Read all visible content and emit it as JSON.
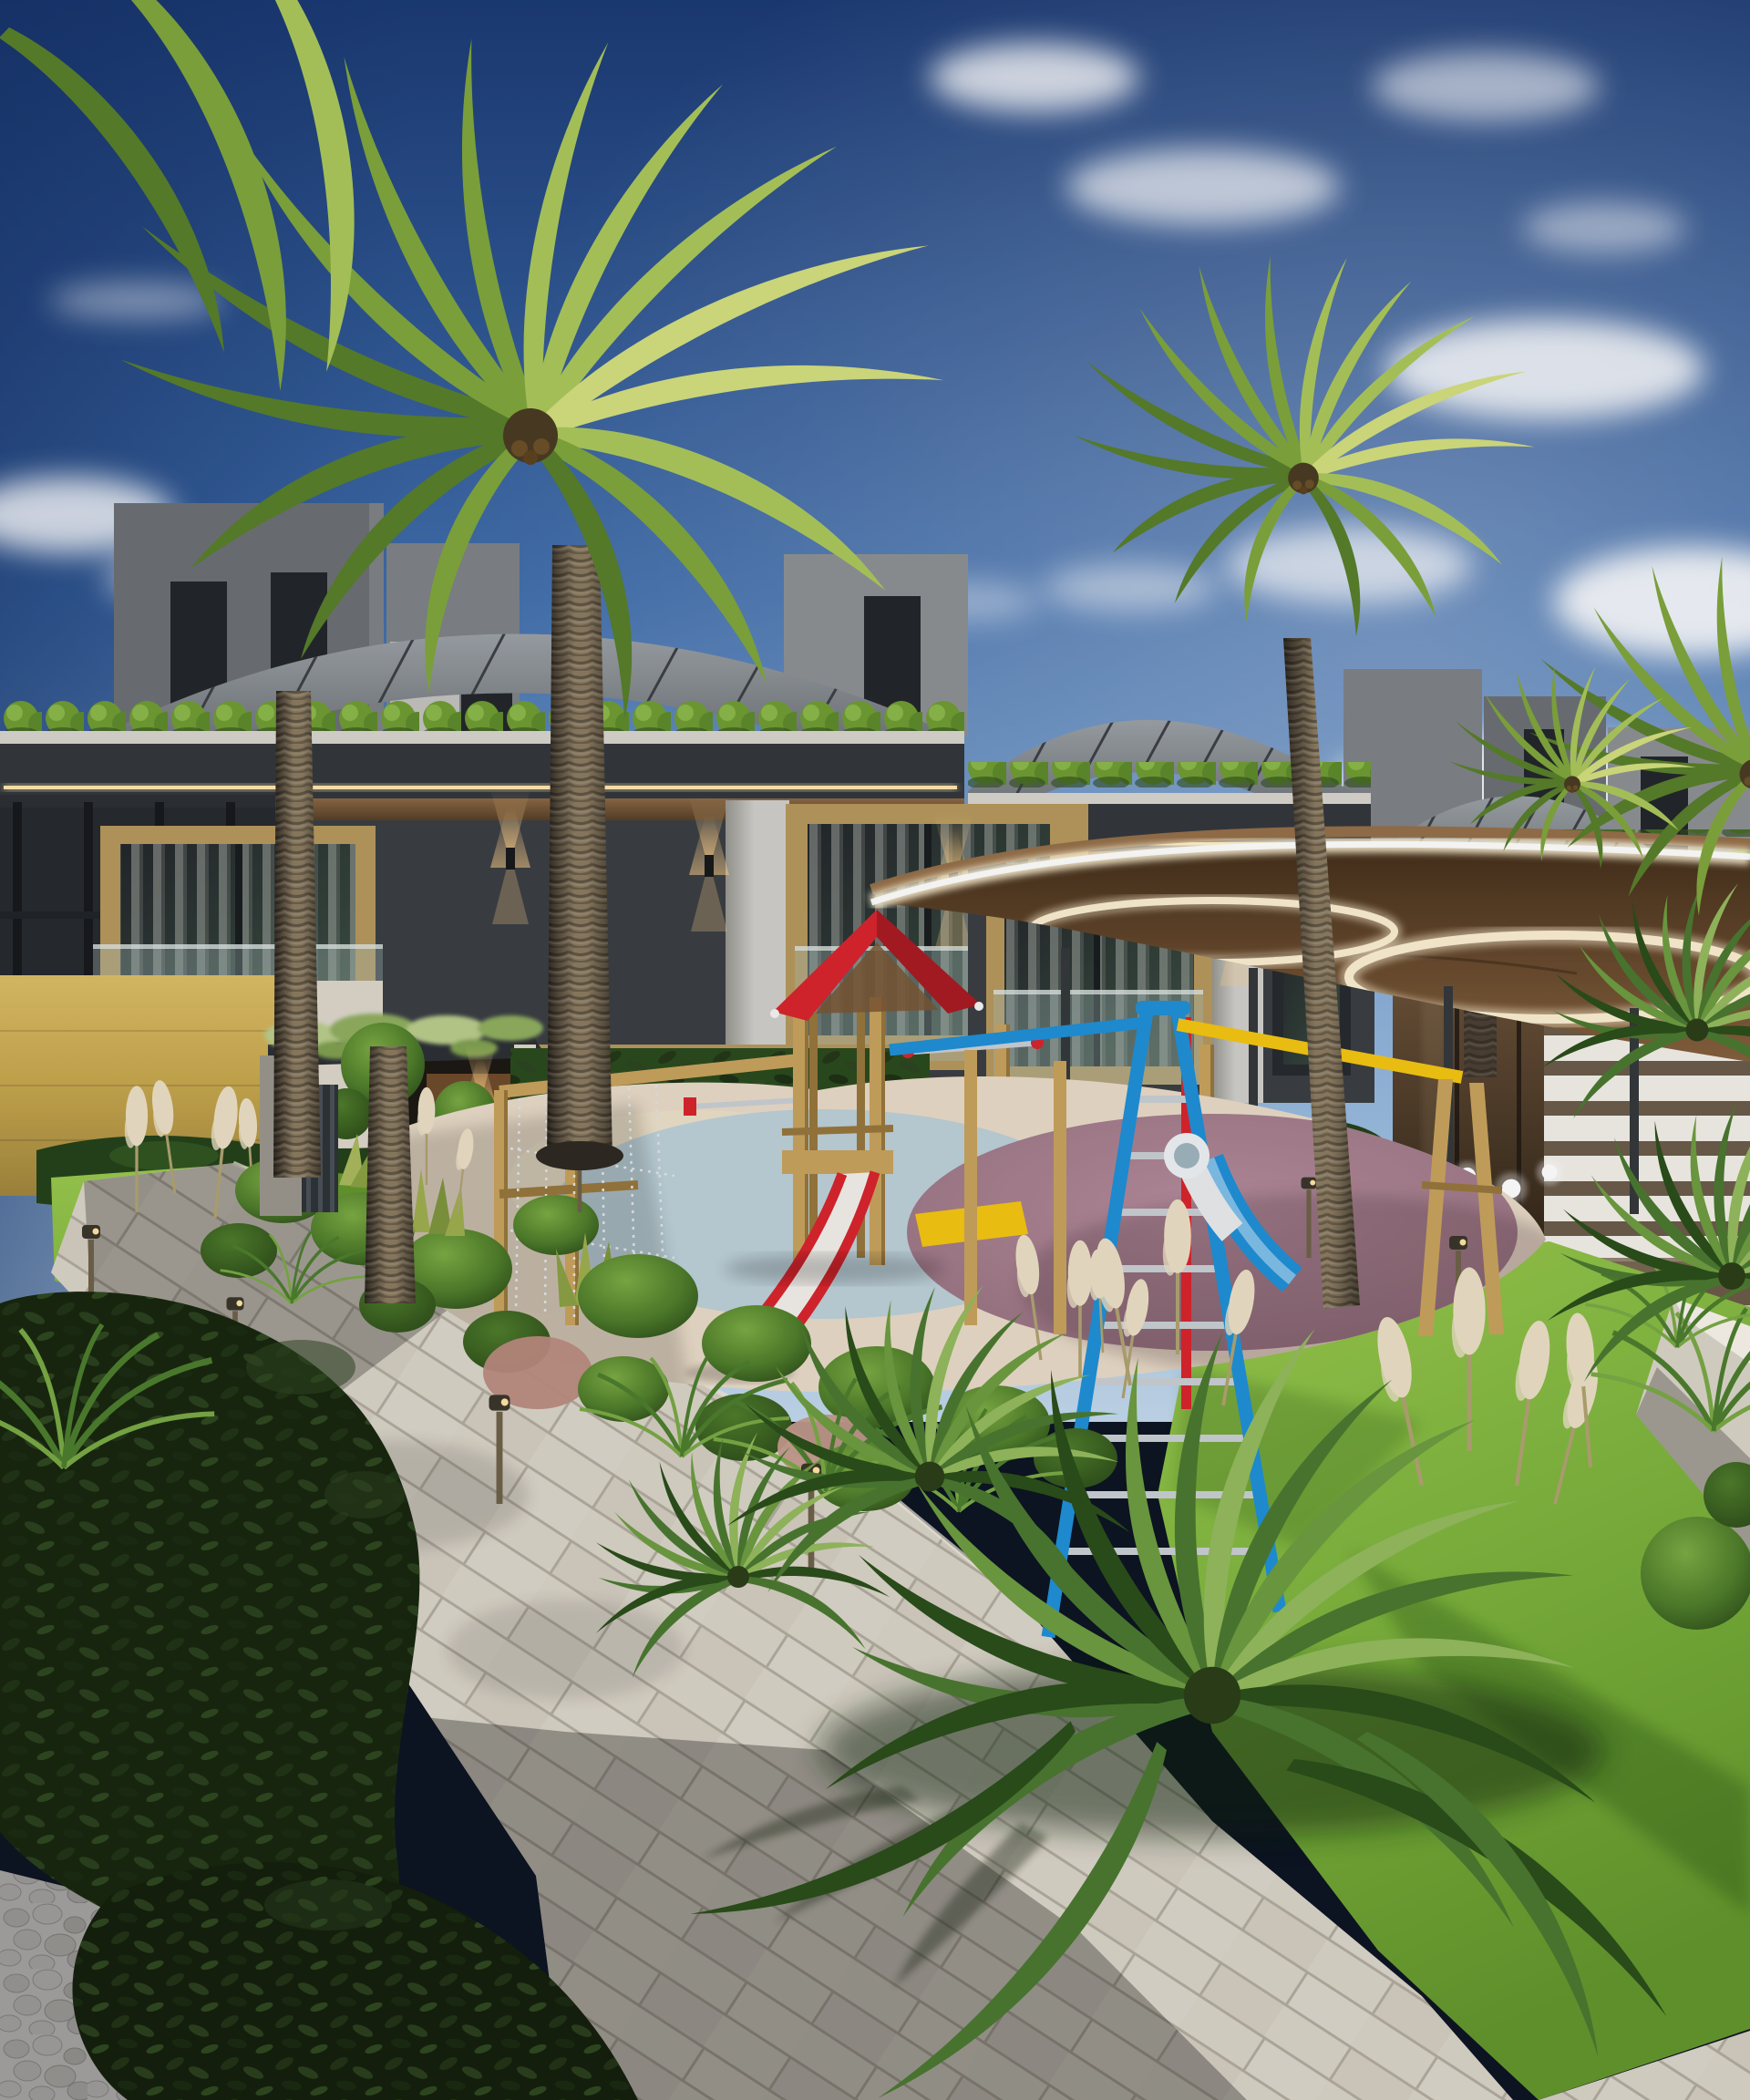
{
  "meta": {
    "title": "Residential complex exterior 3D rendering",
    "description": "Architectural visualization of a modern townhouse row with curved standing-seam roofs, rooftop planters, wood-panel facades, a large glowing circular canopy, a colorful wooden children's playground, palm trees, lush landscaped garden beds, pampas grass, a tiled walkway and garden lights under a blue sky with clouds."
  },
  "palette": {
    "sky-top": "#1b3a74",
    "sky-mid": "#3f6dab",
    "sky-low": "#82abd6",
    "sky-horizon": "#c3d9ec",
    "sky-deep": "#122c60",
    "cloud": "#ffffff",
    "roof-hi": "#9ba1a5",
    "roof-lo": "#595e63",
    "roof-seam": "#3c4045",
    "tower-a": "#6c7074",
    "tower-b": "#8d9093",
    "tower-c": "#c3c2be",
    "tower-d": "#7e8286",
    "win-dark": "#22262a",
    "glass-refl": "#3d5244",
    "planter": "#d7d4cb",
    "fascia": "#33373c",
    "led": "#ffe6ad",
    "soffit": "#8a6844",
    "soffit-dark": "#523b24",
    "wall": "#3a3e43",
    "wall-dark": "#26292d",
    "pier": "#cfcec9",
    "pier-shade": "#97968f",
    "wood": "#b5985c",
    "wood-dark": "#8d7441",
    "balust": "#a9bdba",
    "curtain": "#e9e8e3",
    "gold-hi": "#dcbd64",
    "gold": "#c6a64d",
    "gold-dark": "#a0853c",
    "stone": "#dcd6c9",
    "door": "#6e4a2a",
    "vine": "#b9cc8a",
    "sconce": "#ffd089",
    "canopy-under": "#85603c",
    "canopy-under-dark": "#432e1a",
    "canopy-rim": "#fff3d4",
    "canopy-wood": "#946f49",
    "column": "#34383b",
    "glasswall-a": "#75593e",
    "glasswall-b": "#261d12",
    "gate": "#f2efe7",
    "grass-hi": "#9ac94e",
    "grass-sun": "#7cb23c",
    "grass-lo": "#63962c",
    "grass-shade": "#3f6b20",
    "hedge": "#24421a",
    "hedge-hi": "#3d6527",
    "bush-hi": "#7cab43",
    "bush": "#4e7c2a",
    "bush-dark": "#2c4c1a",
    "leafbush": "#18260f",
    "leafbush-hi": "#2e4520",
    "pampas": "#eadfc4",
    "pampas-stem": "#b0a270",
    "fern": "#4c7d2d",
    "fern-hi": "#79a844",
    "cycad": "#4a7830",
    "cycad-hi": "#6d9c3f",
    "cycad-lite": "#93ba5c",
    "cycad-dark": "#2a4d1a",
    "palm-1": "#d3de7e",
    "palm-2": "#abc75a",
    "palm-3": "#7fa53c",
    "palm-4": "#587e2a",
    "trunk-hi": "#8a7a60",
    "trunk-lo": "#463e31",
    "trunk-dark": "#2e2821",
    "path-sun": "#d9d3c6",
    "grout": "#b2ab9e",
    "path-edge": "#efe9dc",
    "pebble-bg": "#dedad2",
    "pebble": "#cbc7be",
    "pebble-dark": "#a6a199",
    "rubber-cream": "#e8dac6",
    "rubber-blue": "#b9cfd8",
    "rubber-mauve-hi": "#b58c9c",
    "rubber-mauve": "#97717f",
    "rubber-mauve-dark": "#7d5f6b",
    "sand": "#eadfc7",
    "play-red": "#d8242c",
    "play-red-dark": "#a81b22",
    "play-blue": "#1f8fd6",
    "play-blue-dark": "#176fae",
    "play-yellow": "#f4c511",
    "play-wood": "#c8a25c",
    "play-wood-dark": "#97763c",
    "chain": "#dfe3e6",
    "silver": "#c9ced3",
    "slide-bed": "#f2efe9",
    "globe": "#ffffff"
  },
  "scene": {
    "sky": {
      "label": "blue sky with scattered clouds",
      "cloud_count": 15
    },
    "buildings": {
      "label": "modern townhouse row",
      "units_visible": 3,
      "features": [
        "curved standing-seam metal roofs",
        "rooftop planter hedges",
        "LED strip lighting",
        "charcoal panel facade",
        "wood window surrounds",
        "glass balustrades",
        "curtained windows",
        "up-down wall sconces",
        "gold travertine entrance volume",
        "entrance pergola with vines"
      ]
    },
    "canopy": {
      "label": "circular illuminated canopy",
      "light_rings": 2,
      "supports": [
        "steel columns",
        "timber posts"
      ]
    },
    "playground": {
      "label": "children's wooden playground",
      "equipment": [
        "red gable-roof tower",
        "red slide with white bed",
        "blue slide",
        "white tube slide",
        "blue A-frame ladder",
        "yellow swing beam",
        "monkey bars",
        "chain climbing net",
        "timber posts"
      ],
      "surface": [
        "cream rubber",
        "light-blue rubber circle",
        "mauve rubber circle",
        "sand patch"
      ]
    },
    "vegetation": {
      "palms": 5,
      "cycads": 5,
      "topiary_tree": 1,
      "other": [
        "boxwood balls",
        "pampas grass plumes",
        "snake plants",
        "ferns",
        "dark laurel bushes",
        "ivy hedge walls",
        "lawn"
      ]
    },
    "hardscape": {
      "walkway": "light tiled path, running bond",
      "pebble_bed": "white pebbles",
      "shadows": [
        "tree shadow band",
        "fern shadow"
      ]
    },
    "lighting": {
      "globe_lamps": 12,
      "bollard_spotlights": 7,
      "wall_sconces": 6,
      "led_strips": 3
    }
  }
}
